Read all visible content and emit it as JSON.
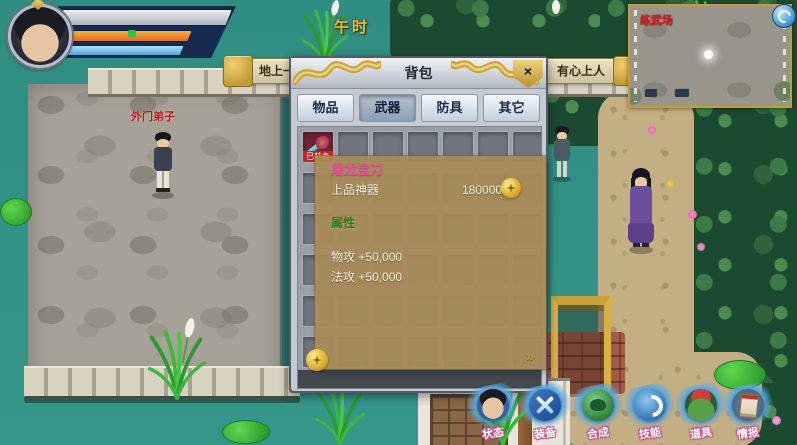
{
  "hud": {
    "time_label": "午时",
    "announcement": {
      "left_fragment": "地上一群蚂",
      "right_fragment": "有心上人"
    },
    "npc_label": "外门弟子",
    "minimap": {
      "map_name": "练武场"
    }
  },
  "backpack": {
    "title": "背包",
    "close_glyph": "×",
    "tabs": [
      {
        "label": "物品"
      },
      {
        "label": "武器"
      },
      {
        "label": "防具"
      },
      {
        "label": "其它"
      }
    ],
    "selected_tab": "武器",
    "equipped_badge": "已装备",
    "tooltip": {
      "item_name": "屠龙宝刀",
      "grade": "上品神器",
      "price": "180000",
      "attributes_header": "属性",
      "stats": [
        {
          "label": "物攻",
          "value": "+50,000"
        },
        {
          "label": "法攻",
          "value": "+50,000"
        }
      ],
      "more_glyph": "»"
    }
  },
  "action_bar": {
    "buttons": [
      {
        "label": "状态"
      },
      {
        "label": "装备"
      },
      {
        "label": "合成"
      },
      {
        "label": "技能"
      },
      {
        "label": "道具"
      },
      {
        "label": "情报"
      }
    ]
  },
  "colors": {
    "hp_bar": "#e06a10",
    "mp_bar": "#38a2d8",
    "accent_gold": "#d8b048",
    "item_name_pink": "#e4549c",
    "attribute_green": "#2e7a1e"
  }
}
